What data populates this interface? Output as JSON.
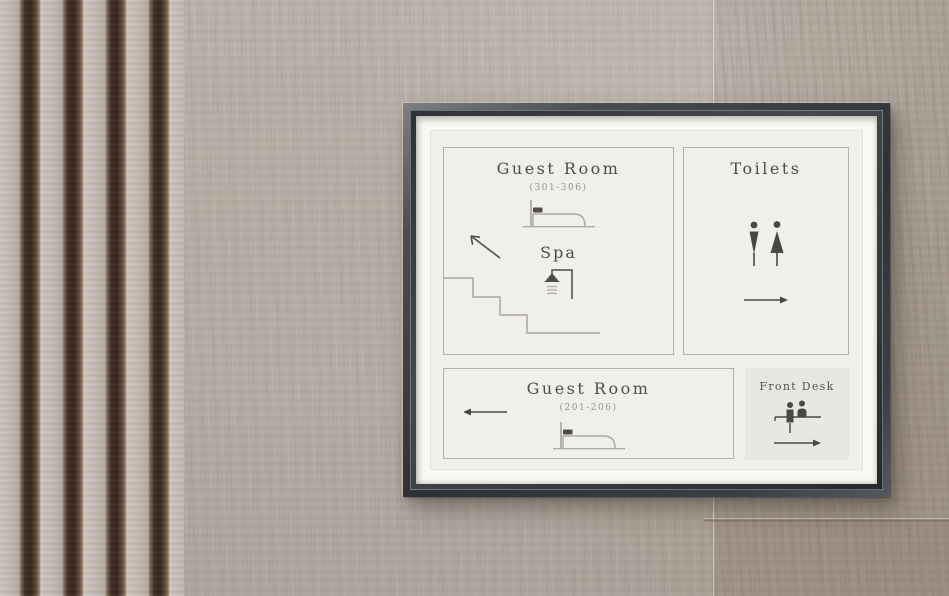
{
  "sign": {
    "upper_left": {
      "title": "Guest Room",
      "room_range": "(301-306)",
      "spa_label": "Spa",
      "icons": [
        "bed-icon",
        "arrow-up-left-icon",
        "shower-icon",
        "stairs-icon"
      ]
    },
    "toilets": {
      "title": "Toilets",
      "icons": [
        "man-icon",
        "woman-icon",
        "arrow-right-icon"
      ]
    },
    "lower": {
      "title": "Guest Room",
      "room_range": "(201-206)",
      "icons": [
        "arrow-left-icon",
        "bed-icon"
      ]
    },
    "front_desk": {
      "title": "Front Desk",
      "icons": [
        "reception-desk-icon",
        "arrow-right-icon"
      ]
    }
  },
  "colors": {
    "frame": "#35383c",
    "mat": "#f9f8f4",
    "sign_background": "#f1efe9",
    "panel_border": "#b2b0a8",
    "front_desk_background": "#e9e7e1",
    "ink": "#4f4d49",
    "ink_muted": "#94928c",
    "icon_light": "#adaba4",
    "wall": "#b3aaa1",
    "slat_dark": "#3c2c23",
    "slat_light": "#c9c2bb"
  }
}
